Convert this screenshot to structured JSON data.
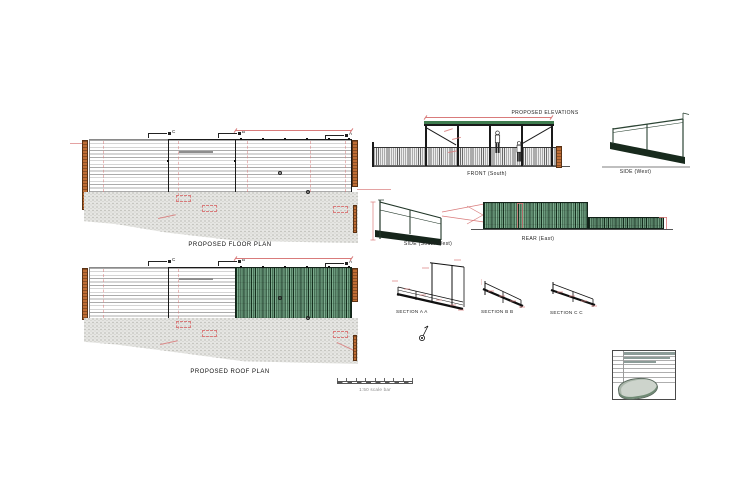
{
  "colors": {
    "paper": "#ffffff",
    "line-dark": "#1a1a1a",
    "annot-red": "#d97b7b",
    "timber": "#bf6d35",
    "deck-line": "#ababab",
    "concrete": "#e6e6e3",
    "roof-green-dark": "#16301f",
    "roof-green-light": "#7fae90",
    "frame-green": "#2c4434",
    "ground-line": "#555555"
  },
  "plans": {
    "floor": {
      "label": "PROPOSED FLOOR PLAN"
    },
    "roof": {
      "label": "PROPOSED ROOF PLAN"
    },
    "section_markers": {
      "a": "A",
      "b": "B",
      "c": "C"
    }
  },
  "elevations": {
    "title": "PROPOSED ELEVATIONS",
    "front": {
      "label": "FRONT (South)"
    },
    "side_west": {
      "label": "SIDE (West)"
    },
    "side_south_west": {
      "label": "SIDE (South-West)"
    },
    "rear": {
      "label": "REAR (East)"
    }
  },
  "sections": {
    "a": {
      "label": "SECTION A A"
    },
    "b": {
      "label": "SECTION B B"
    },
    "c": {
      "label": "SECTION C C"
    }
  },
  "scale_bar": {
    "caption": "1:50 scale bar"
  }
}
